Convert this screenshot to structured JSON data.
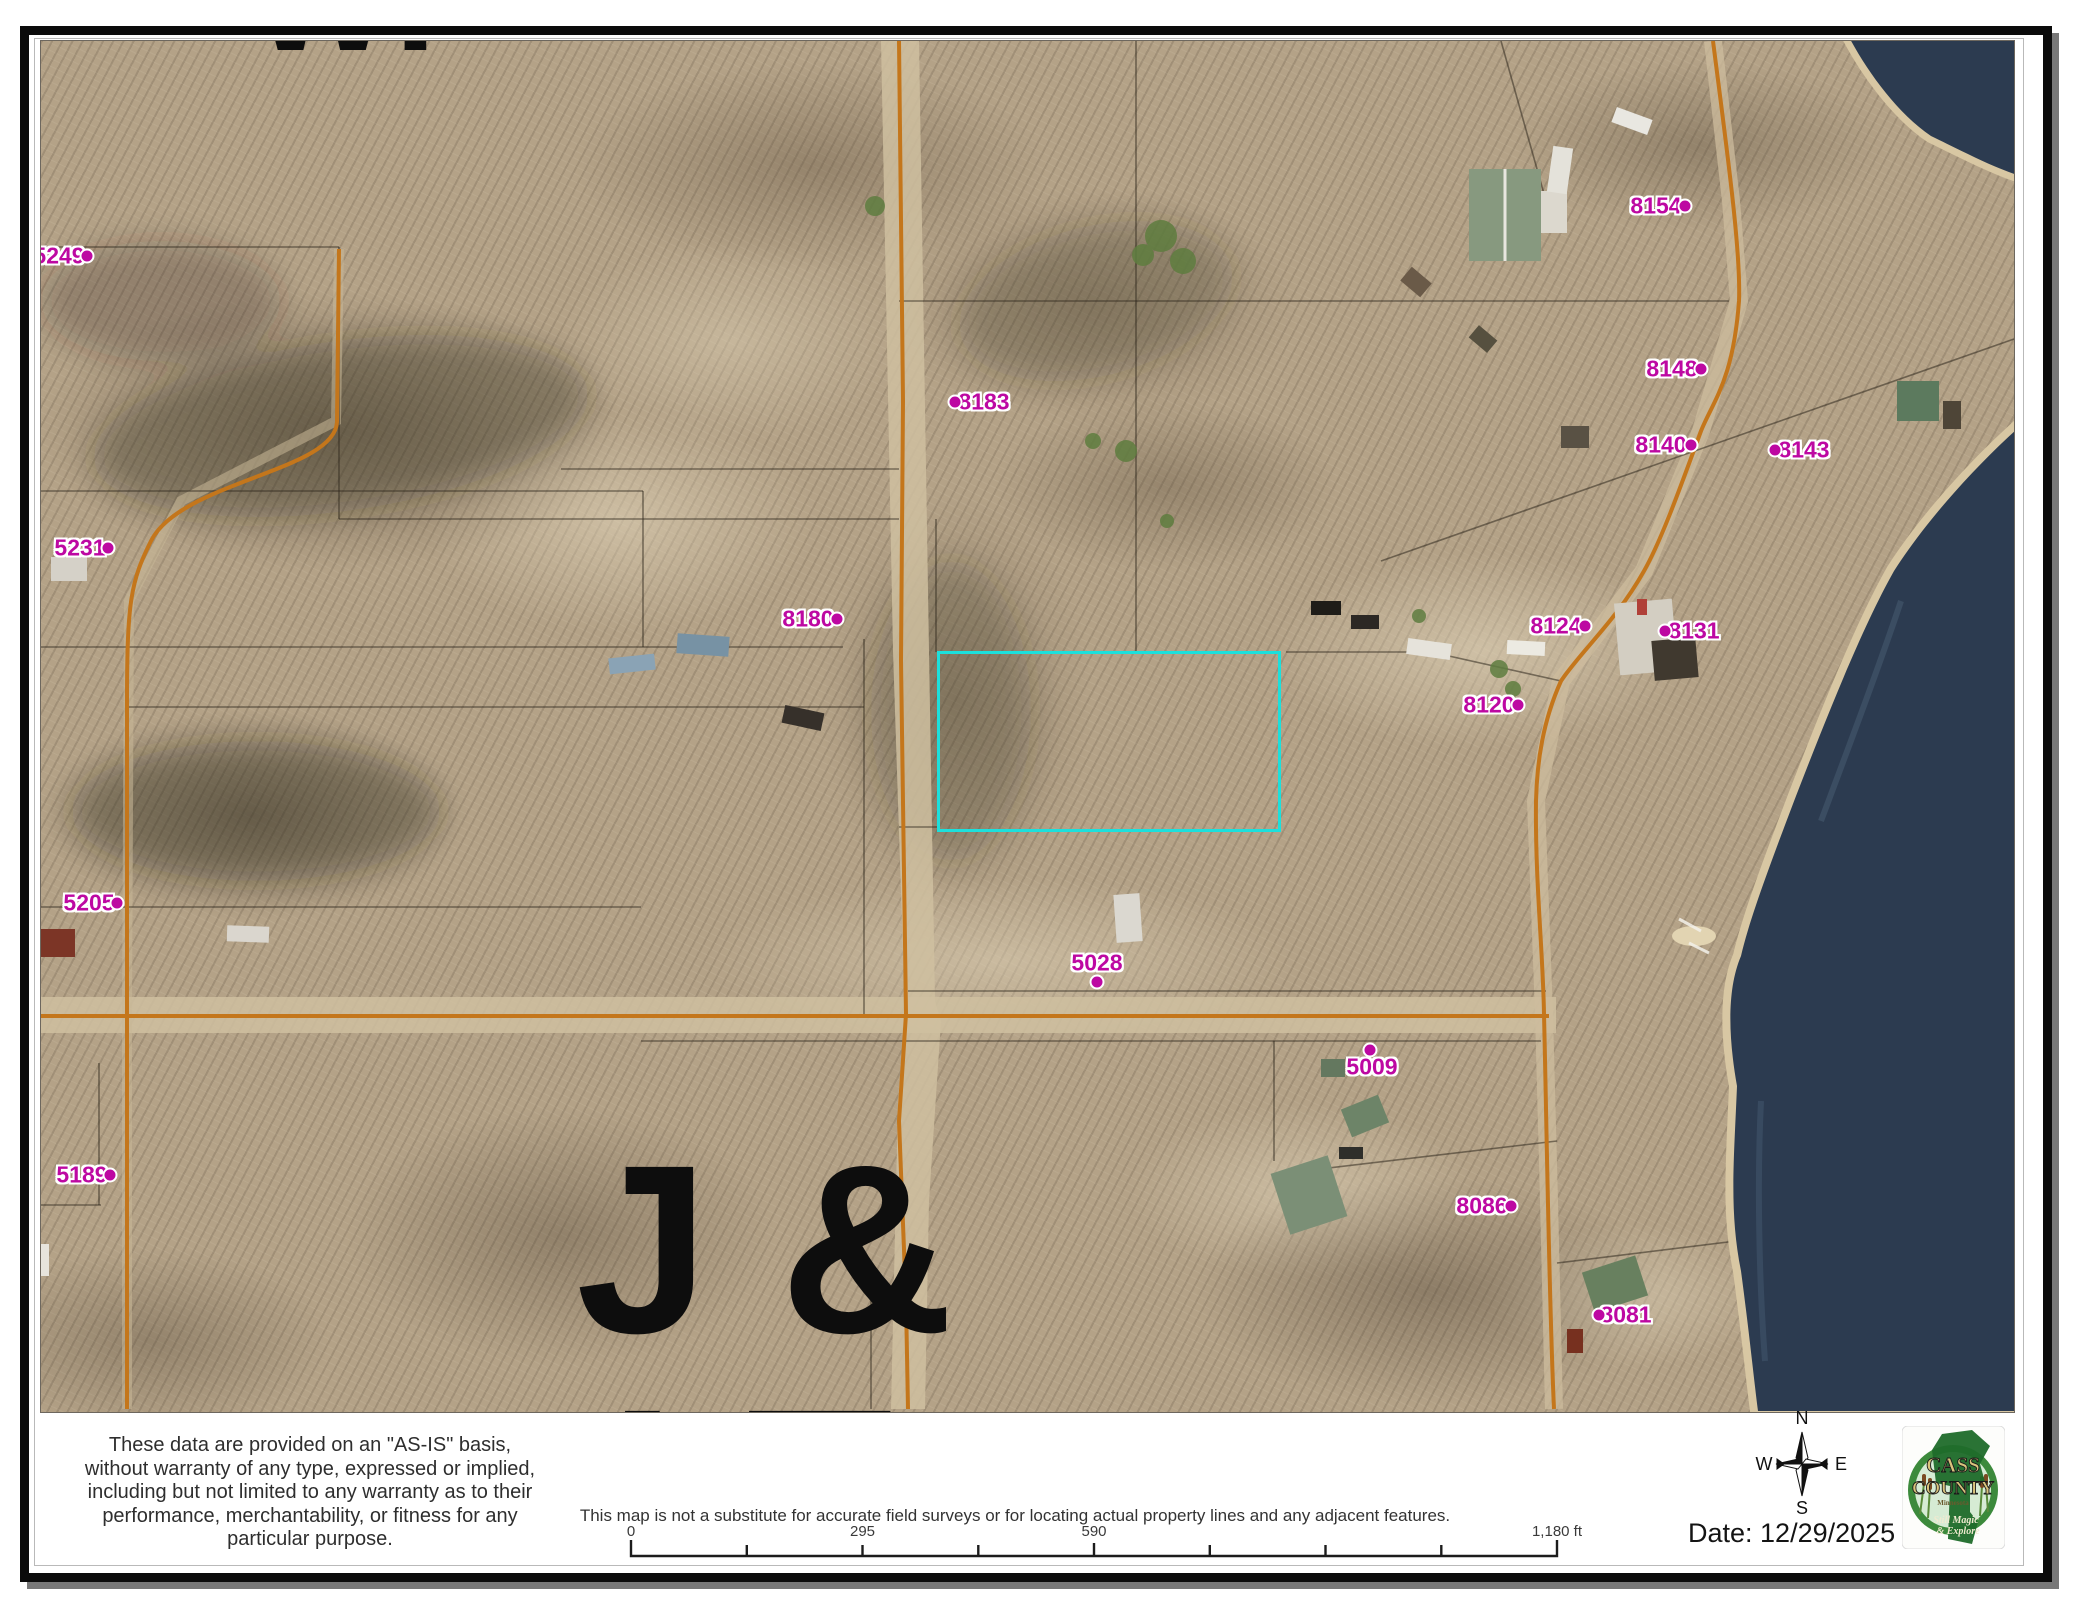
{
  "map": {
    "big_labels": {
      "top": "WI",
      "middle": "J &",
      "bottom": "I T"
    },
    "label_color": "#bd08a2",
    "highlight_color": "#1ce0dc",
    "road_color": "#c4761b",
    "lake_color": "#2c3b50",
    "parcel_labels": [
      {
        "text": "5249",
        "tx": 58,
        "ty": 255,
        "dx": 86,
        "dy": 255
      },
      {
        "text": "5231",
        "tx": 79,
        "ty": 547,
        "dx": 107,
        "dy": 547
      },
      {
        "text": "5205",
        "tx": 88,
        "ty": 902,
        "dx": 116,
        "dy": 902
      },
      {
        "text": "5189",
        "tx": 81,
        "ty": 1174,
        "dx": 109,
        "dy": 1174
      },
      {
        "text": "8180",
        "tx": 807,
        "ty": 618,
        "dx": 836,
        "dy": 618
      },
      {
        "text": "8183",
        "tx": 983,
        "ty": 401,
        "dx": 954,
        "dy": 401
      },
      {
        "text": "8154",
        "tx": 1655,
        "ty": 205,
        "dx": 1684,
        "dy": 205
      },
      {
        "text": "8148",
        "tx": 1671,
        "ty": 368,
        "dx": 1700,
        "dy": 368
      },
      {
        "text": "8140",
        "tx": 1660,
        "ty": 444,
        "dx": 1690,
        "dy": 444
      },
      {
        "text": "8143",
        "tx": 1803,
        "ty": 449,
        "dx": 1774,
        "dy": 449
      },
      {
        "text": "8124",
        "tx": 1555,
        "ty": 625,
        "dx": 1584,
        "dy": 625
      },
      {
        "text": "8131",
        "tx": 1693,
        "ty": 630,
        "dx": 1664,
        "dy": 630
      },
      {
        "text": "8120",
        "tx": 1488,
        "ty": 704,
        "dx": 1517,
        "dy": 704
      },
      {
        "text": "5028",
        "tx": 1096,
        "ty": 962,
        "dx": 1096,
        "dy": 981
      },
      {
        "text": "5009",
        "tx": 1371,
        "ty": 1066,
        "dx": 1369,
        "dy": 1049
      },
      {
        "text": "8086",
        "tx": 1481,
        "ty": 1205,
        "dx": 1510,
        "dy": 1205
      },
      {
        "text": "8081",
        "tx": 1625,
        "ty": 1314,
        "dx": 1598,
        "dy": 1314
      }
    ]
  },
  "footer": {
    "disclaimer": "These data are provided on an \"AS-IS\" basis,\nwithout warranty of any type, expressed or implied,\nincluding but not limited to any warranty as to their\nperformance, merchantability, or fitness for any\nparticular purpose.",
    "note": "This map is not a substitute for accurate field surveys or for locating actual property lines and any adjacent features.",
    "date_label": "Date: 12/29/2025",
    "scalebar": {
      "labels": [
        "0",
        "295",
        "590",
        "1,180 ft"
      ]
    },
    "compass": {
      "n": "N",
      "w": "W",
      "e": "E",
      "s": "S"
    },
    "logo": {
      "name_line1": "CASS",
      "name_line2": "COUNTY",
      "state": "Minnesota",
      "tagline1": "Still Magic",
      "tagline2": "& Explore"
    }
  }
}
